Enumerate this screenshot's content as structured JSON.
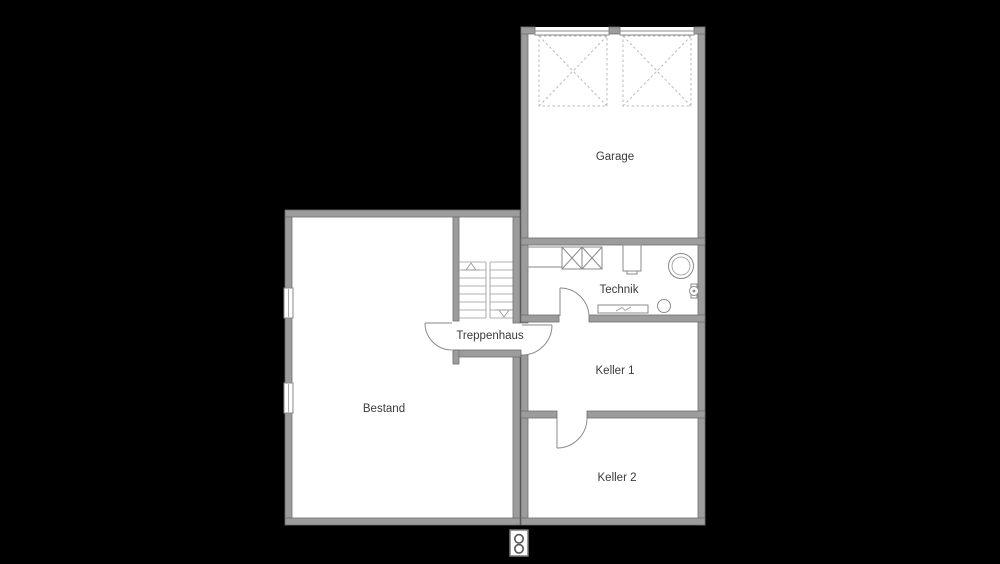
{
  "plan": {
    "title": "basement-floor-plan",
    "colors": {
      "background": "#000000",
      "floor": "#ffffff",
      "wall_fill": "#9c9c9c",
      "wall_edge": "#6e6e6e",
      "drawing_line": "#8a8a8a",
      "dashed_line": "#b9b9b9",
      "label_text": "#3a3a3a"
    },
    "rooms": {
      "garage": {
        "label": "Garage"
      },
      "technik": {
        "label": "Technik"
      },
      "keller_1": {
        "label": "Keller 1"
      },
      "keller_2": {
        "label": "Keller 2"
      },
      "treppenhaus": {
        "label": "Treppenhaus"
      },
      "bestand": {
        "label": "Bestand"
      }
    },
    "symbols": {
      "garage_door_swings": 2,
      "window_symbols": 2,
      "door_swings": 4,
      "stair_arrows": [
        "up",
        "down"
      ],
      "technik_fixtures": [
        "counter-with-two-crossed-appliances",
        "wall-boiler",
        "storage-tank-double-circle",
        "small-pump-valve",
        "radiator-strip",
        "floor-drain-circle"
      ],
      "inspection_shaft_circles": 2
    }
  }
}
